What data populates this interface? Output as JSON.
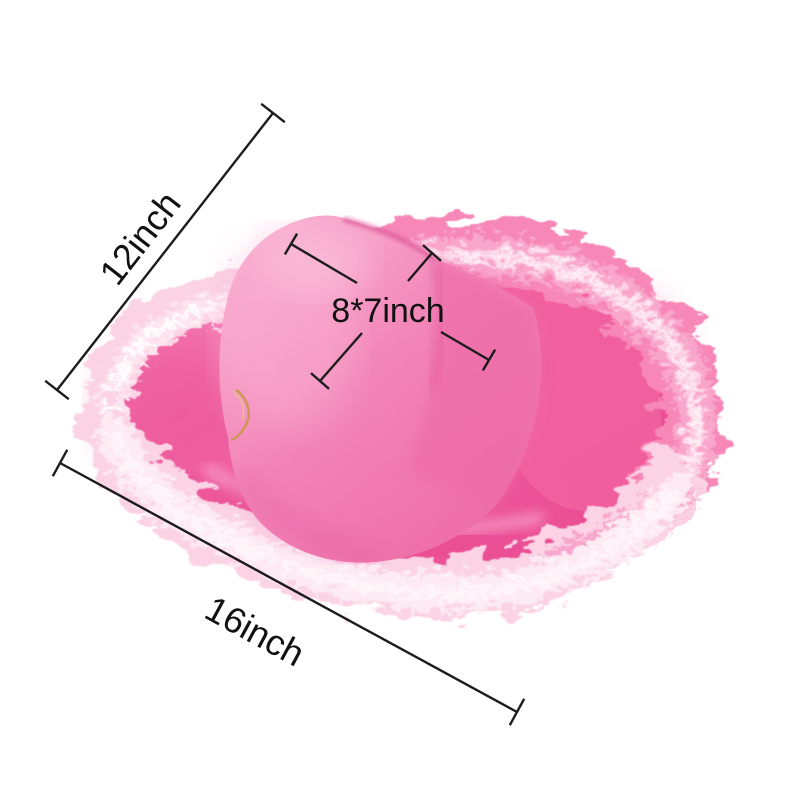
{
  "image": {
    "subject": "Pink cowboy hat with fluffy feather boa trim shown with size dimensions",
    "labels": {
      "diagonal": "12inch",
      "width": "16inch",
      "crown": "8*7inch"
    },
    "colors": {
      "background": "#ffffff",
      "dimension_line": "#1c1c1c",
      "label_text": "#111111",
      "crown_pink": "#f285b8",
      "crown_highlight": "#f9aed0",
      "crown_shade": "#ee6ba7",
      "crown_crease": "#d6478d",
      "brim_light": "#f47db3",
      "brim_pink": "#ef5c9f",
      "brim_shadow": "#e8488f",
      "brim_highlight": "#f7a0c8",
      "boa_hot_pink": "#f687b7",
      "boa_mid_pink": "#f9a6cb",
      "boa_light_pink": "#fbd3e5",
      "boa_pale": "#fdeaf2",
      "boa_white": "#fff6fa",
      "cord_gold": "#cf9757"
    }
  }
}
